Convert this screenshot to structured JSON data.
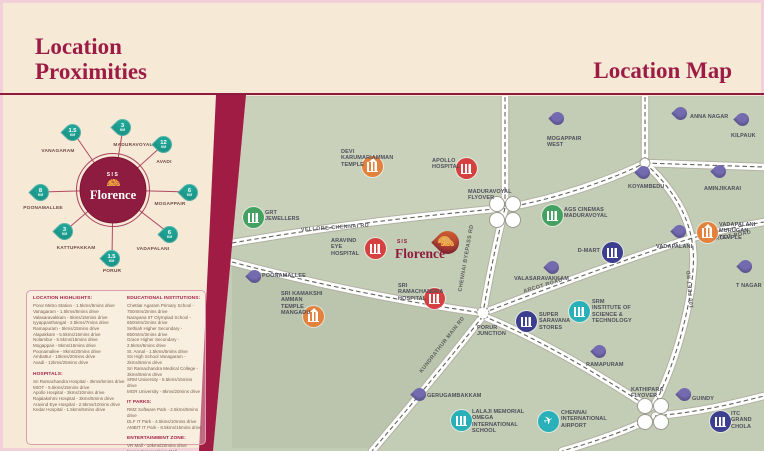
{
  "page": {
    "title_left_line1": "Location",
    "title_left_line2": "Proximities",
    "title_right": "Location Map"
  },
  "brand": {
    "sis": "SIS",
    "name": "Florence"
  },
  "diagram": {
    "spokes": [
      {
        "value": "1.5",
        "unit": "KM",
        "label": "VANAGARAM"
      },
      {
        "value": "3",
        "unit": "KM",
        "label": "MADURAVOYAL"
      },
      {
        "value": "12",
        "unit": "KM",
        "label": "AVADI"
      },
      {
        "value": "6",
        "unit": "KM",
        "label": "MOGAPPAIR"
      },
      {
        "value": "8",
        "unit": "KM",
        "label": "POONAMALLEE"
      },
      {
        "value": "3",
        "unit": "KM",
        "label": "KATTUPAKKAM"
      },
      {
        "value": "1.5",
        "unit": "KM",
        "label": "PORUR"
      },
      {
        "value": "6",
        "unit": "KM",
        "label": "VADAPALANI"
      }
    ]
  },
  "lists": {
    "location_highlights": {
      "title": "LOCATION HIGHLIGHTS:",
      "items": [
        "Porur Metro Station - 1.5kms/5mins drive",
        "Vanagaram - 1.5kms/5mins drive",
        "Valasaravakkam - 5kms/15mins drive",
        "Iyyappanthangal - 2.5kms/7mins drive",
        "Ramapuram - 5kms/15mins drive",
        "Alapakkam - 5.5kms/15mins drive",
        "Nolambur - 5.5kms/15mins drive",
        "Mogappair - 8kms/15mins drive",
        "Poonamallee - 8kms/20mins drive",
        "Ambattur - 10kms/20mins drive",
        "Avadi - 12kms/25mins drive"
      ]
    },
    "hospitals": {
      "title": "HOSPITALS:",
      "items": [
        "Sri Ramachandra Hospital - 3kms/5mins drive",
        "MIOT - 5.5kms/15mins drive",
        "Apollo Hospital - 3kms/10mins drive",
        "Rajalakshmi Hospital - 3kms/5mins drive",
        "Aravind Eye Hospital - 2.5kms/10mins drive",
        "Kedar Hospital - 1.5kms/5mins drive"
      ]
    },
    "educational": {
      "title": "EDUCATIONAL INSTITUTIONS:",
      "items": [
        "Chettiar Agaram Primary School - 750mtrs/2mins drive",
        "Narayana IIT Olympiad School - 650mtrs/2mins drive",
        "Sethiah Higher Secondary - 850mtrs/3mins drive",
        "Grace Higher Secondary - 2.5kms/5mins drive",
        "St. Annal - 1.5kms/5mins drive",
        "SS High School Vanagaram - 2kms/5mins drive",
        "Sri Ramachandra Medical College - 3kms/5mins drive",
        "SRM University - 5.5kms/15mins drive",
        "MGR University - 8kms/20mins drive"
      ]
    },
    "it_parks": {
      "title": "IT PARKS:",
      "items": [
        "RMZ Software Park - 2.5kms/5mins drive",
        "DLF IT Park - 4.5kms/10mins drive",
        "AMBIT IT Park - 8.5kms/15mins drive"
      ]
    },
    "entertainment": {
      "title": "ENTERTAINMENT ZONE:",
      "items": [
        "VR Mall - 10kms/20mins drive",
        "Nexus Forum Vijaya Mall - 10kms/20mins drive",
        "Saravana Stores - 3kms/7mins drive"
      ]
    }
  },
  "map": {
    "road_labels": [
      "VELLORE-CHENNAI RD",
      "CHENNAI BYEPASS RD",
      "ARCOT ROAD",
      "ARCOT ROAD",
      "100 FEET RD",
      "KUNDRATHUR MAIN RD"
    ],
    "pois": [
      {
        "label": "DEVI KARUMARIAMMAN TEMPLE"
      },
      {
        "label": "APOLLO HOSPITAL"
      },
      {
        "label": "MADURAVOYAL FLYOVER"
      },
      {
        "label": "GRT JEWELLERS"
      },
      {
        "label": "AGS CINEMAS MADURAVOYAL"
      },
      {
        "label": "MOGAPPAIR WEST"
      },
      {
        "label": "ANNA NAGAR"
      },
      {
        "label": "KILPAUK"
      },
      {
        "label": "KOYAMBEDU"
      },
      {
        "label": "AMINJIKARAI"
      },
      {
        "label": "VADAPALANI MURUGAN TEMPLE"
      },
      {
        "label": "VADAPALANI"
      },
      {
        "label": "T NAGAR"
      },
      {
        "label": "D-MART"
      },
      {
        "label": "VALASARAVAKKAM"
      },
      {
        "label": "SRM INSTITUTE OF SCIENCE & TECHNOLOGY"
      },
      {
        "label": "SUPER SARAVANA STORES"
      },
      {
        "label": "PORUR JUNCTION"
      },
      {
        "label": "SRI RAMACHANDRA HOSPITAL"
      },
      {
        "label": "ARAVIND EYE HOSPITAL"
      },
      {
        "label": "POONAMALLEE"
      },
      {
        "label": "SRI KAMAKSHI AMMAN TEMPLE MANGADU"
      },
      {
        "label": "GERUGAMBAKKAM"
      },
      {
        "label": "LALAJI MEMORIAL OMEGA INTERNATIONAL SCHOOL"
      },
      {
        "label": "CHENNAI INTERNATIONAL AIRPORT"
      },
      {
        "label": "RAMAPURAM"
      },
      {
        "label": "KATHIPARA FLYOVER"
      },
      {
        "label": "GUINDY"
      },
      {
        "label": "ITC GRAND CHOLA"
      }
    ]
  },
  "colors": {
    "accent_maroon": "#9c1c45",
    "band_maroon": "#a11c44",
    "cream_bg": "#f6e9d6",
    "map_bg": "#c3ccb4",
    "pin_teal": "#1b9e90",
    "pin_purple": "#746ab0",
    "icon_temple_orange": "#e2823c",
    "icon_hospital_red": "#d64040",
    "icon_green": "#44a162",
    "icon_navy": "#3c3e8f",
    "icon_teal": "#2ab0b8",
    "project_pin_red": "#b8402f"
  }
}
